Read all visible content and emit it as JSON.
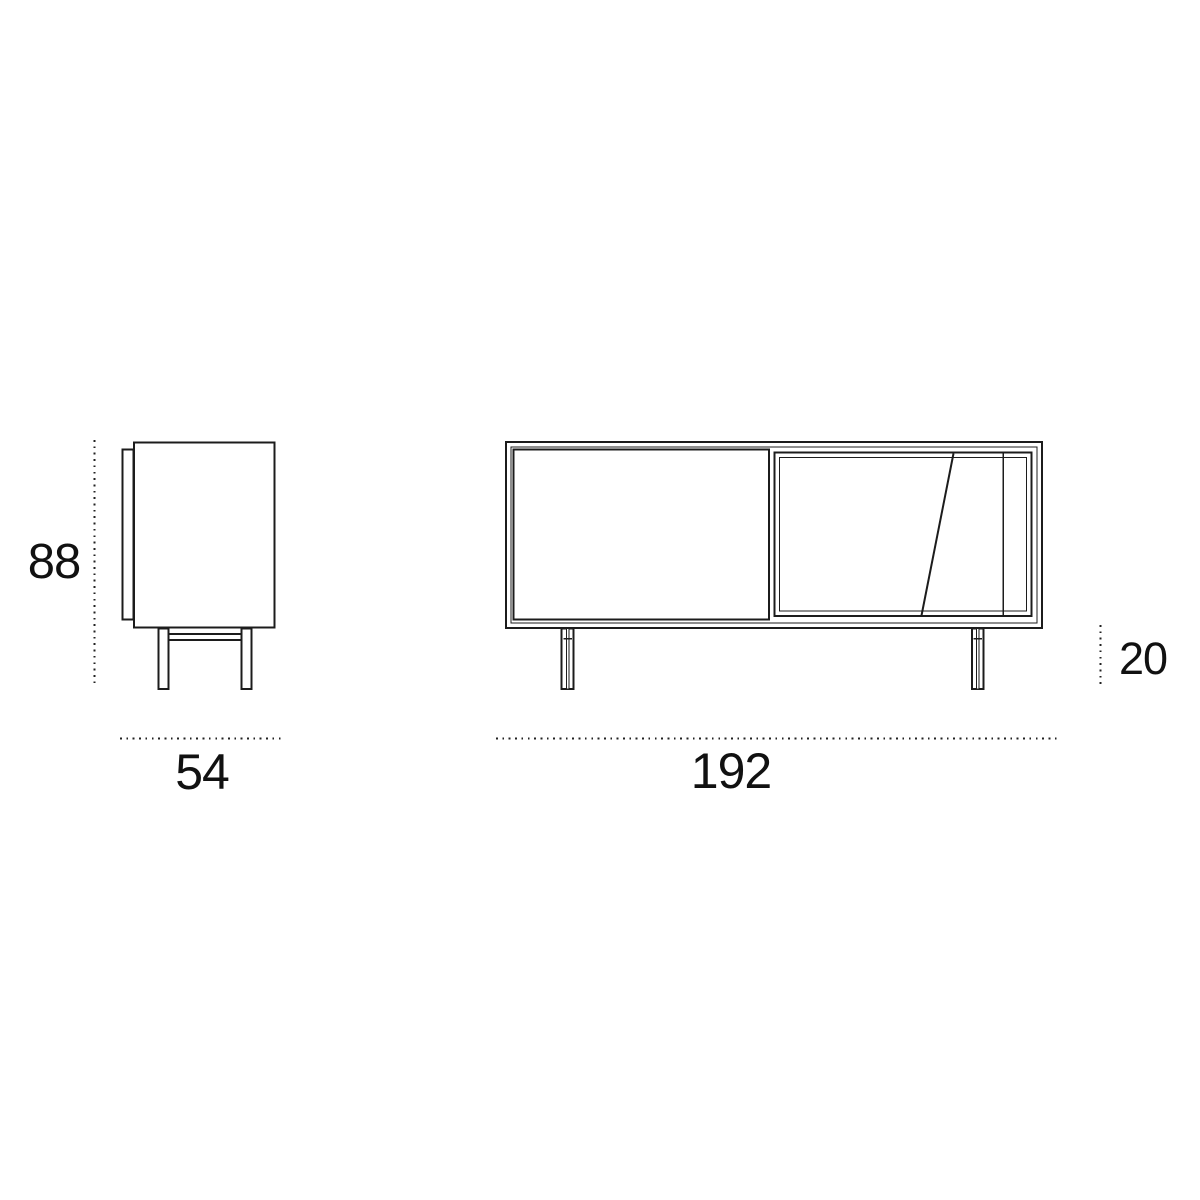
{
  "page": {
    "background_color": "#ffffff"
  },
  "diagram": {
    "stroke_color": "#1c1c1c",
    "dimension_dot_color": "#222222",
    "labels": {
      "side_height": "88",
      "side_depth": "54",
      "front_width": "192",
      "front_leg_height": "20"
    }
  }
}
